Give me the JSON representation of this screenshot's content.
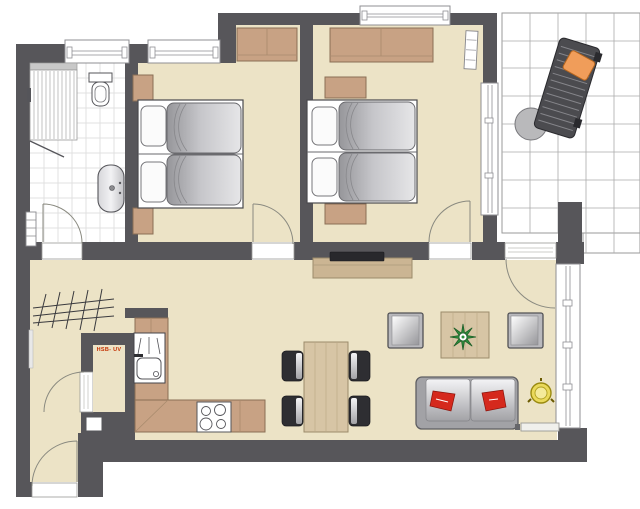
{
  "plan": {
    "utility_label": "HSB- UV",
    "rooms": [
      "bathroom",
      "bedroom-1",
      "bedroom-2",
      "hallway",
      "utility-closet",
      "kitchen",
      "living-dining-area",
      "terrace"
    ],
    "furniture": [
      "shower",
      "toilet",
      "washbasin",
      "towel-radiator",
      "double-bed",
      "pillow",
      "duvet",
      "nightstand",
      "wardrobe",
      "radiator",
      "coat-rack",
      "kitchen-counter",
      "kitchen-sink",
      "stove",
      "sideboard",
      "tv",
      "dining-table",
      "dining-chair",
      "coffee-table",
      "plant",
      "armchair",
      "sofa",
      "red-cushion",
      "side-table",
      "doormat",
      "sun-lounger",
      "lounger-pillow",
      "terrace-table",
      "door",
      "window",
      "shaft"
    ],
    "colors": {
      "wall": "#57565a",
      "floor": "#ece3c6",
      "tile_white": "#ffffff",
      "wood": "#c8a284",
      "wood_light": "#d7c5a5",
      "mattress_gray": "#bcbcc0",
      "accent_red": "#d5291d",
      "accent_orange": "#f09d5a",
      "accent_yellow": "#ead95b",
      "accent_green": "#2d8f3c",
      "label_red": "#c33000"
    }
  }
}
